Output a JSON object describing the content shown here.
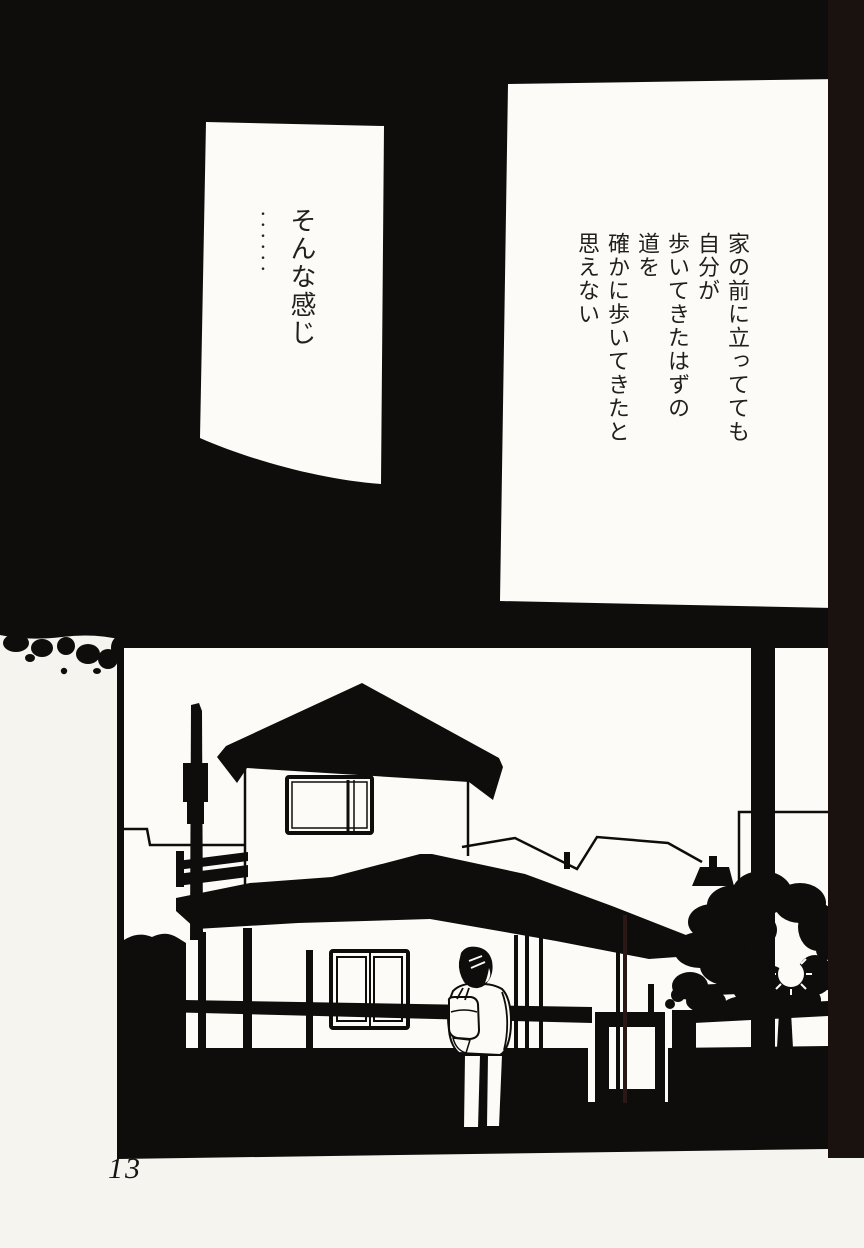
{
  "page": {
    "number": "13"
  },
  "panels": {
    "speech_bubble": {
      "lines": [
        "そんな感じ",
        "••••••"
      ]
    },
    "narration": {
      "lines": [
        "家の前に立ってても",
        "自分が",
        "歩いてきたはずの",
        "道を",
        "確かに歩いてきたと",
        "思えない"
      ]
    }
  },
  "colors": {
    "ink": "#0e0d0b",
    "paper": "#f5f4ef",
    "panel_white": "#fcfbf7",
    "text_ink": "#221f1c",
    "page_edge": "#1a120f"
  }
}
